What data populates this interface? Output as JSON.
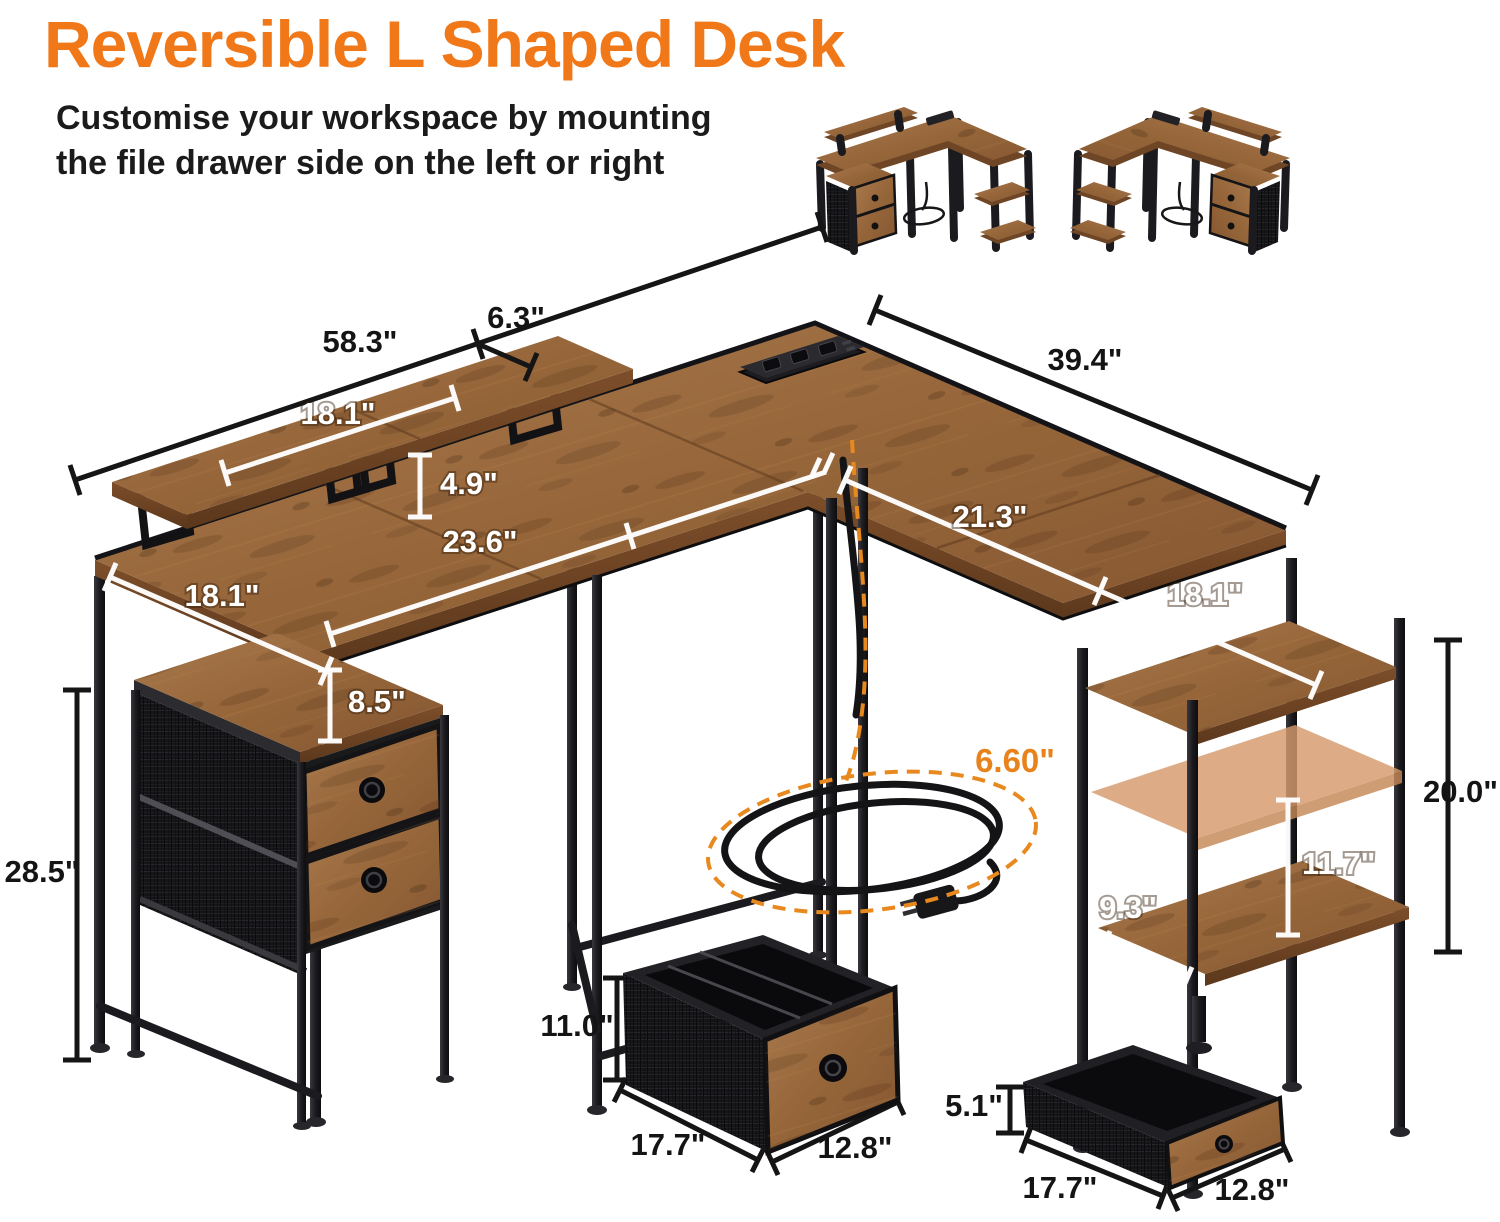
{
  "header": {
    "title": "Reversible L Shaped Desk",
    "subtitle_line1": "Customise your workspace by mounting",
    "subtitle_line2": "the file drawer side on the left or right"
  },
  "colors": {
    "accent_orange": "#F07818",
    "dimension_orange": "#E8831C",
    "wood_brown": "#9a6b40",
    "metal_black": "#1b1b1f",
    "ghost_shelf_tan": "#d69a6d"
  },
  "dims": {
    "desk_total_length": "58.3\"",
    "riser_depth": "6.3\"",
    "riser_segment_length": "18.1\"",
    "riser_height": "4.9\"",
    "desk_depth_left": "18.1\"",
    "desk_front_span": "23.6\"",
    "wing_total_length": "39.4\"",
    "wing_inner_span": "21.3\"",
    "wing_depth": "18.1\"",
    "pedestal_clearance": "8.5\"",
    "desk_height": "28.5\"",
    "shelf_column_height": "20.0\"",
    "shelf_bottom_gap": "11.7\"",
    "bottom_shelf_depth": "9.3\"",
    "power_cord_length": "6.60\"",
    "file_drawer": {
      "height": "11.0\"",
      "depth": "17.7\"",
      "width": "12.8\""
    },
    "small_drawer": {
      "height": "5.1\"",
      "depth": "17.7\"",
      "width": "12.8\""
    }
  }
}
